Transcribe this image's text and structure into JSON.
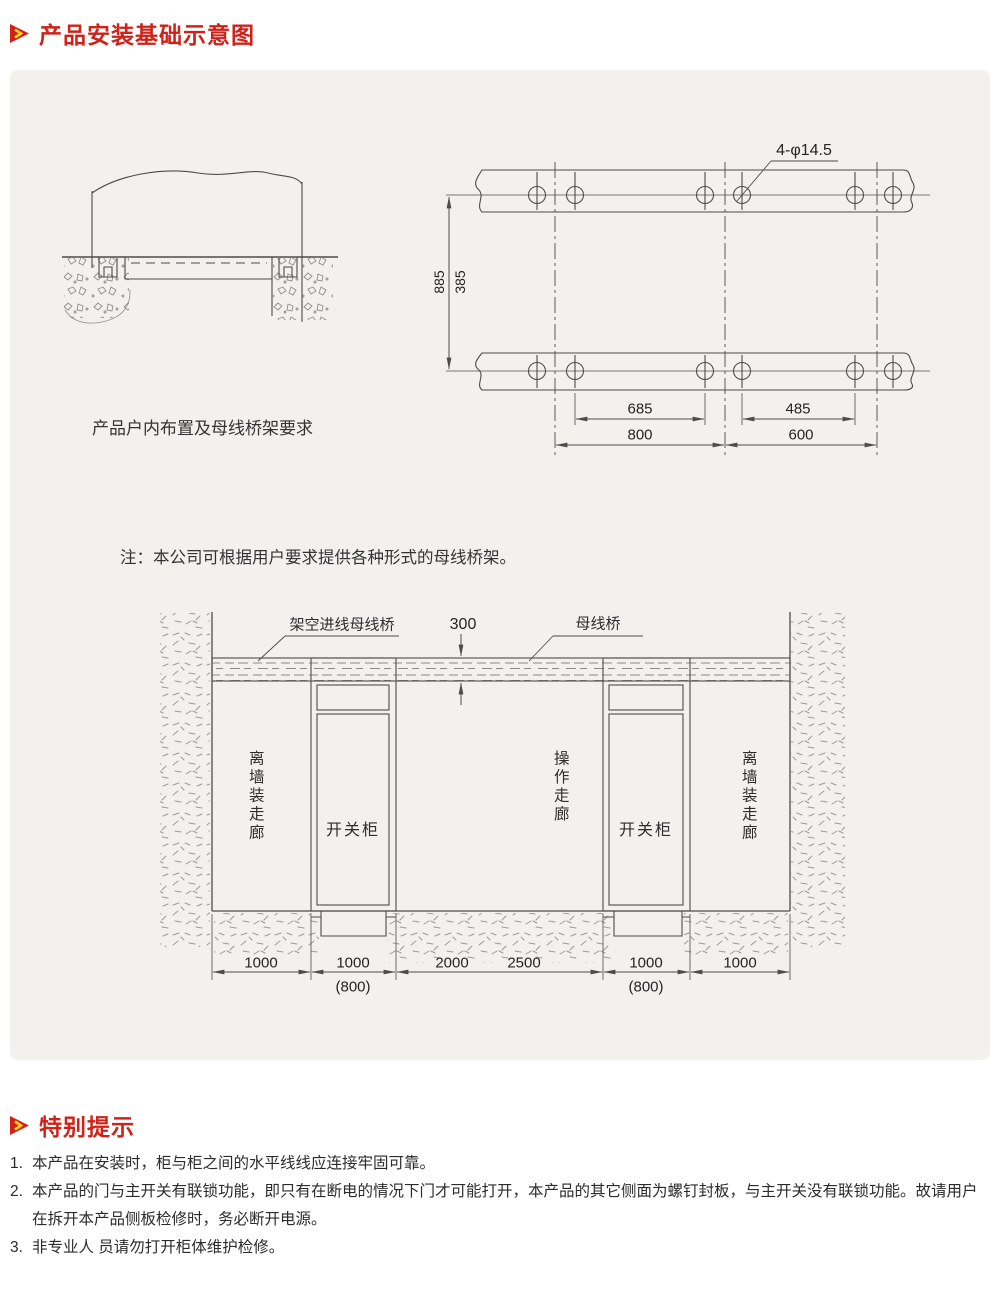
{
  "header": {
    "title": "产品安装基础示意图"
  },
  "install_diagram": {
    "caption": "产品户内布置及母线桥架要求",
    "note": "注：本公司可根据用户要求提供各种形式的母线桥架。",
    "hole_label": "4-φ14.5",
    "dim_885": "885",
    "dim_385": "385",
    "dim_685": "685",
    "dim_485": "485",
    "dim_800": "800",
    "dim_600": "600"
  },
  "layout_diagram": {
    "overhead_busbar_label": "架空进线母线桥",
    "busbar_label": "母线桥",
    "dim_300": "300",
    "corridor_left": "离墙装走廊",
    "corridor_center": "操作走廊",
    "corridor_right": "离墙装走廊",
    "cabinet_left": "开关柜",
    "cabinet_right": "开关柜",
    "dims": [
      "1000",
      "1000",
      "2000",
      "2500",
      "1000",
      "1000"
    ],
    "alt_dims": [
      "(800)",
      "(800)"
    ]
  },
  "notice": {
    "title": "特别提示",
    "items": [
      {
        "num": "1.",
        "text": "本产品在安装时，柜与柜之间的水平线线应连接牢固可靠。"
      },
      {
        "num": "2.",
        "text": "本产品的门与主开关有联锁功能，即只有在断电的情况下门才可能打开，本产品的其它侧面为螺钉封板，与主开关没有联锁功能。故请用户在拆开本产品侧板检修时，务必断开电源。"
      },
      {
        "num": "3.",
        "text": "非专业人 员请勿打开柜体维护检修。"
      }
    ]
  },
  "colors": {
    "accent": "#cf231a",
    "panel": "#f2f1ee",
    "line": "#4c4c4c",
    "icon_yellow": "#ffd21e"
  }
}
